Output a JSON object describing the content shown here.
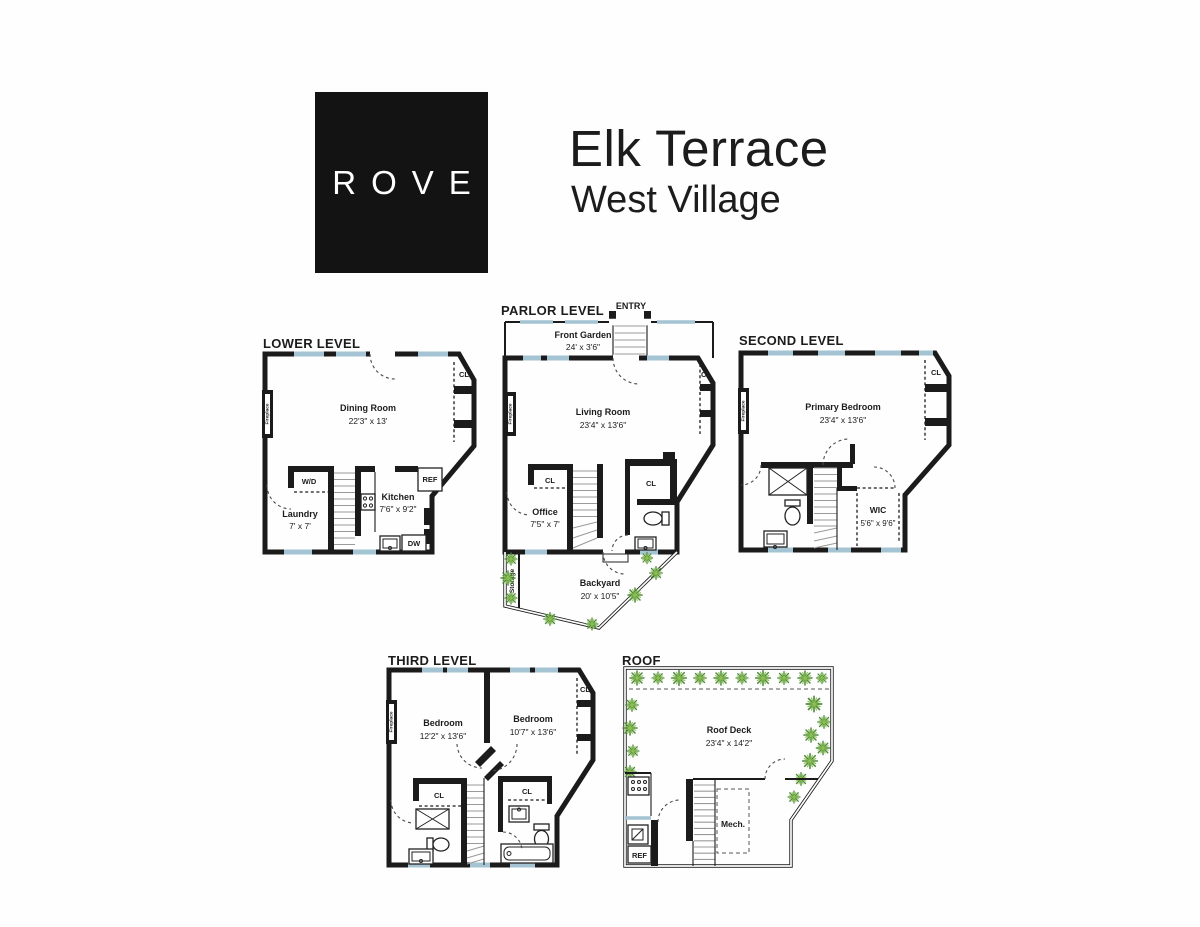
{
  "header": {
    "logo_text": "ROVE",
    "title": "Elk Terrace",
    "subtitle": "West Village"
  },
  "palette": {
    "wall": "#1b1b1b",
    "window": "#a4c4d4",
    "plant_dark": "#4e8c3c",
    "plant_light": "#8cbf50",
    "logo_bg": "#131313",
    "background": "#fefefe"
  },
  "glossary": {
    "closet": "CL",
    "fireplace": "Fireplace",
    "washer_dryer": "W/D",
    "refrigerator": "REF",
    "dishwasher": "DW",
    "storage": "Storage",
    "entry": "ENTRY",
    "mechanical": "Mech."
  },
  "levels": {
    "lower": {
      "title": "LOWER LEVEL",
      "dining": {
        "name": "Dining Room",
        "dims": "22'3\" x 13'"
      },
      "laundry": {
        "name": "Laundry",
        "dims": "7' x 7'"
      },
      "kitchen": {
        "name": "Kitchen",
        "dims": "7'6\" x 9'2\""
      }
    },
    "parlor": {
      "title": "PARLOR LEVEL",
      "front_garden": {
        "name": "Front Garden",
        "dims": "24' x 3'6\""
      },
      "living": {
        "name": "Living Room",
        "dims": "23'4\" x 13'6\""
      },
      "office": {
        "name": "Office",
        "dims": "7'5\" x 7'"
      },
      "backyard": {
        "name": "Backyard",
        "dims": "20' x 10'5\""
      }
    },
    "second": {
      "title": "SECOND LEVEL",
      "primary": {
        "name": "Primary Bedroom",
        "dims": "23'4\" x 13'6\""
      },
      "wic": {
        "name": "WIC",
        "dims": "5'6\" x 9'6\""
      }
    },
    "third": {
      "title": "THIRD LEVEL",
      "bedroom_left": {
        "name": "Bedroom",
        "dims": "12'2\" x 13'6\""
      },
      "bedroom_right": {
        "name": "Bedroom",
        "dims": "10'7\" x 13'6\""
      }
    },
    "roof": {
      "title": "ROOF",
      "deck": {
        "name": "Roof Deck",
        "dims": "23'4\" x 14'2\""
      }
    }
  }
}
